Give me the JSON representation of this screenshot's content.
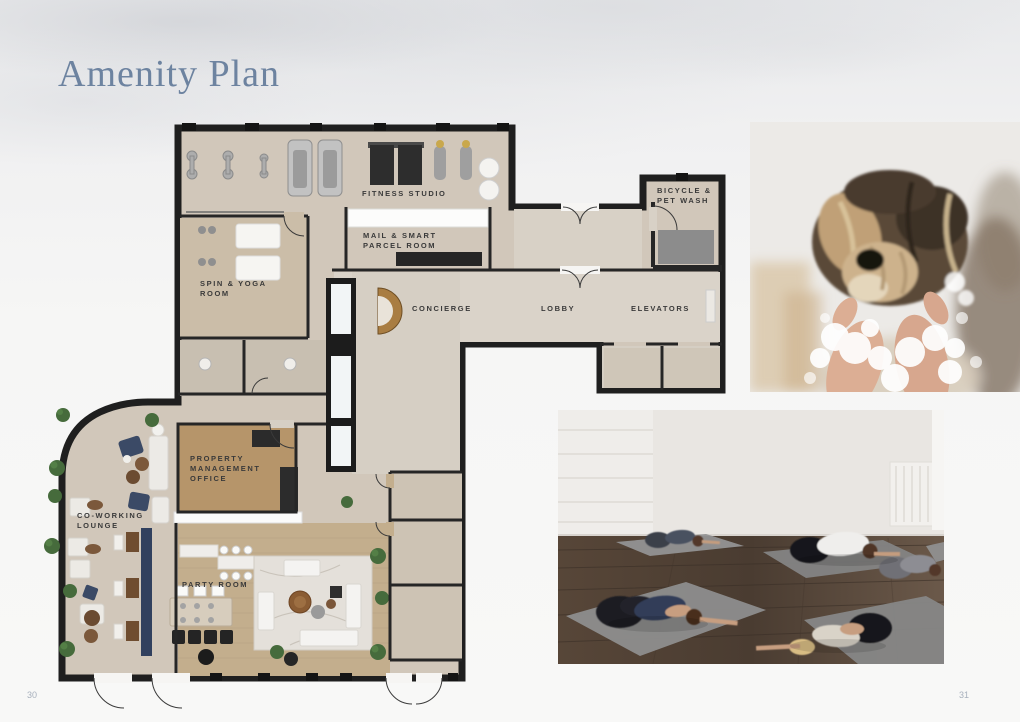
{
  "page": {
    "title": "Amenity Plan",
    "page_number_left": "30",
    "page_number_right": "31"
  },
  "floor_plan": {
    "rooms": {
      "fitness_studio": {
        "label": "FITNESS STUDIO"
      },
      "mail_parcel": {
        "lines": [
          "MAIL & SMART",
          "PARCEL ROOM"
        ]
      },
      "bicycle_pet_wash": {
        "lines": [
          "BICYCLE &",
          "PET WASH"
        ]
      },
      "spin_yoga": {
        "lines": [
          "SPIN & YOGA",
          "ROOM"
        ]
      },
      "concierge": {
        "label": "CONCIERGE"
      },
      "lobby": {
        "label": "LOBBY"
      },
      "elevators": {
        "label": "ELEVATORS"
      },
      "property_management": {
        "lines": [
          "PROPERTY",
          "MANAGEMENT",
          "OFFICE"
        ]
      },
      "coworking": {
        "lines": [
          "CO-WORKING",
          "LOUNGE"
        ]
      },
      "party_room": {
        "label": "PARTY ROOM"
      }
    },
    "colors": {
      "wall": "#1f1f1f",
      "floor": "#d1c7ba",
      "floor_light": "#d8d1c6",
      "wood_office": "#b6956a",
      "wood_party": "#c3ae8d",
      "concierge_desk": "#a97d42",
      "navy_furniture": "#3b4a66",
      "plant_green": "#466b3c",
      "label_text": "#3a3a3a",
      "title_text": "#6d83a0"
    }
  }
}
